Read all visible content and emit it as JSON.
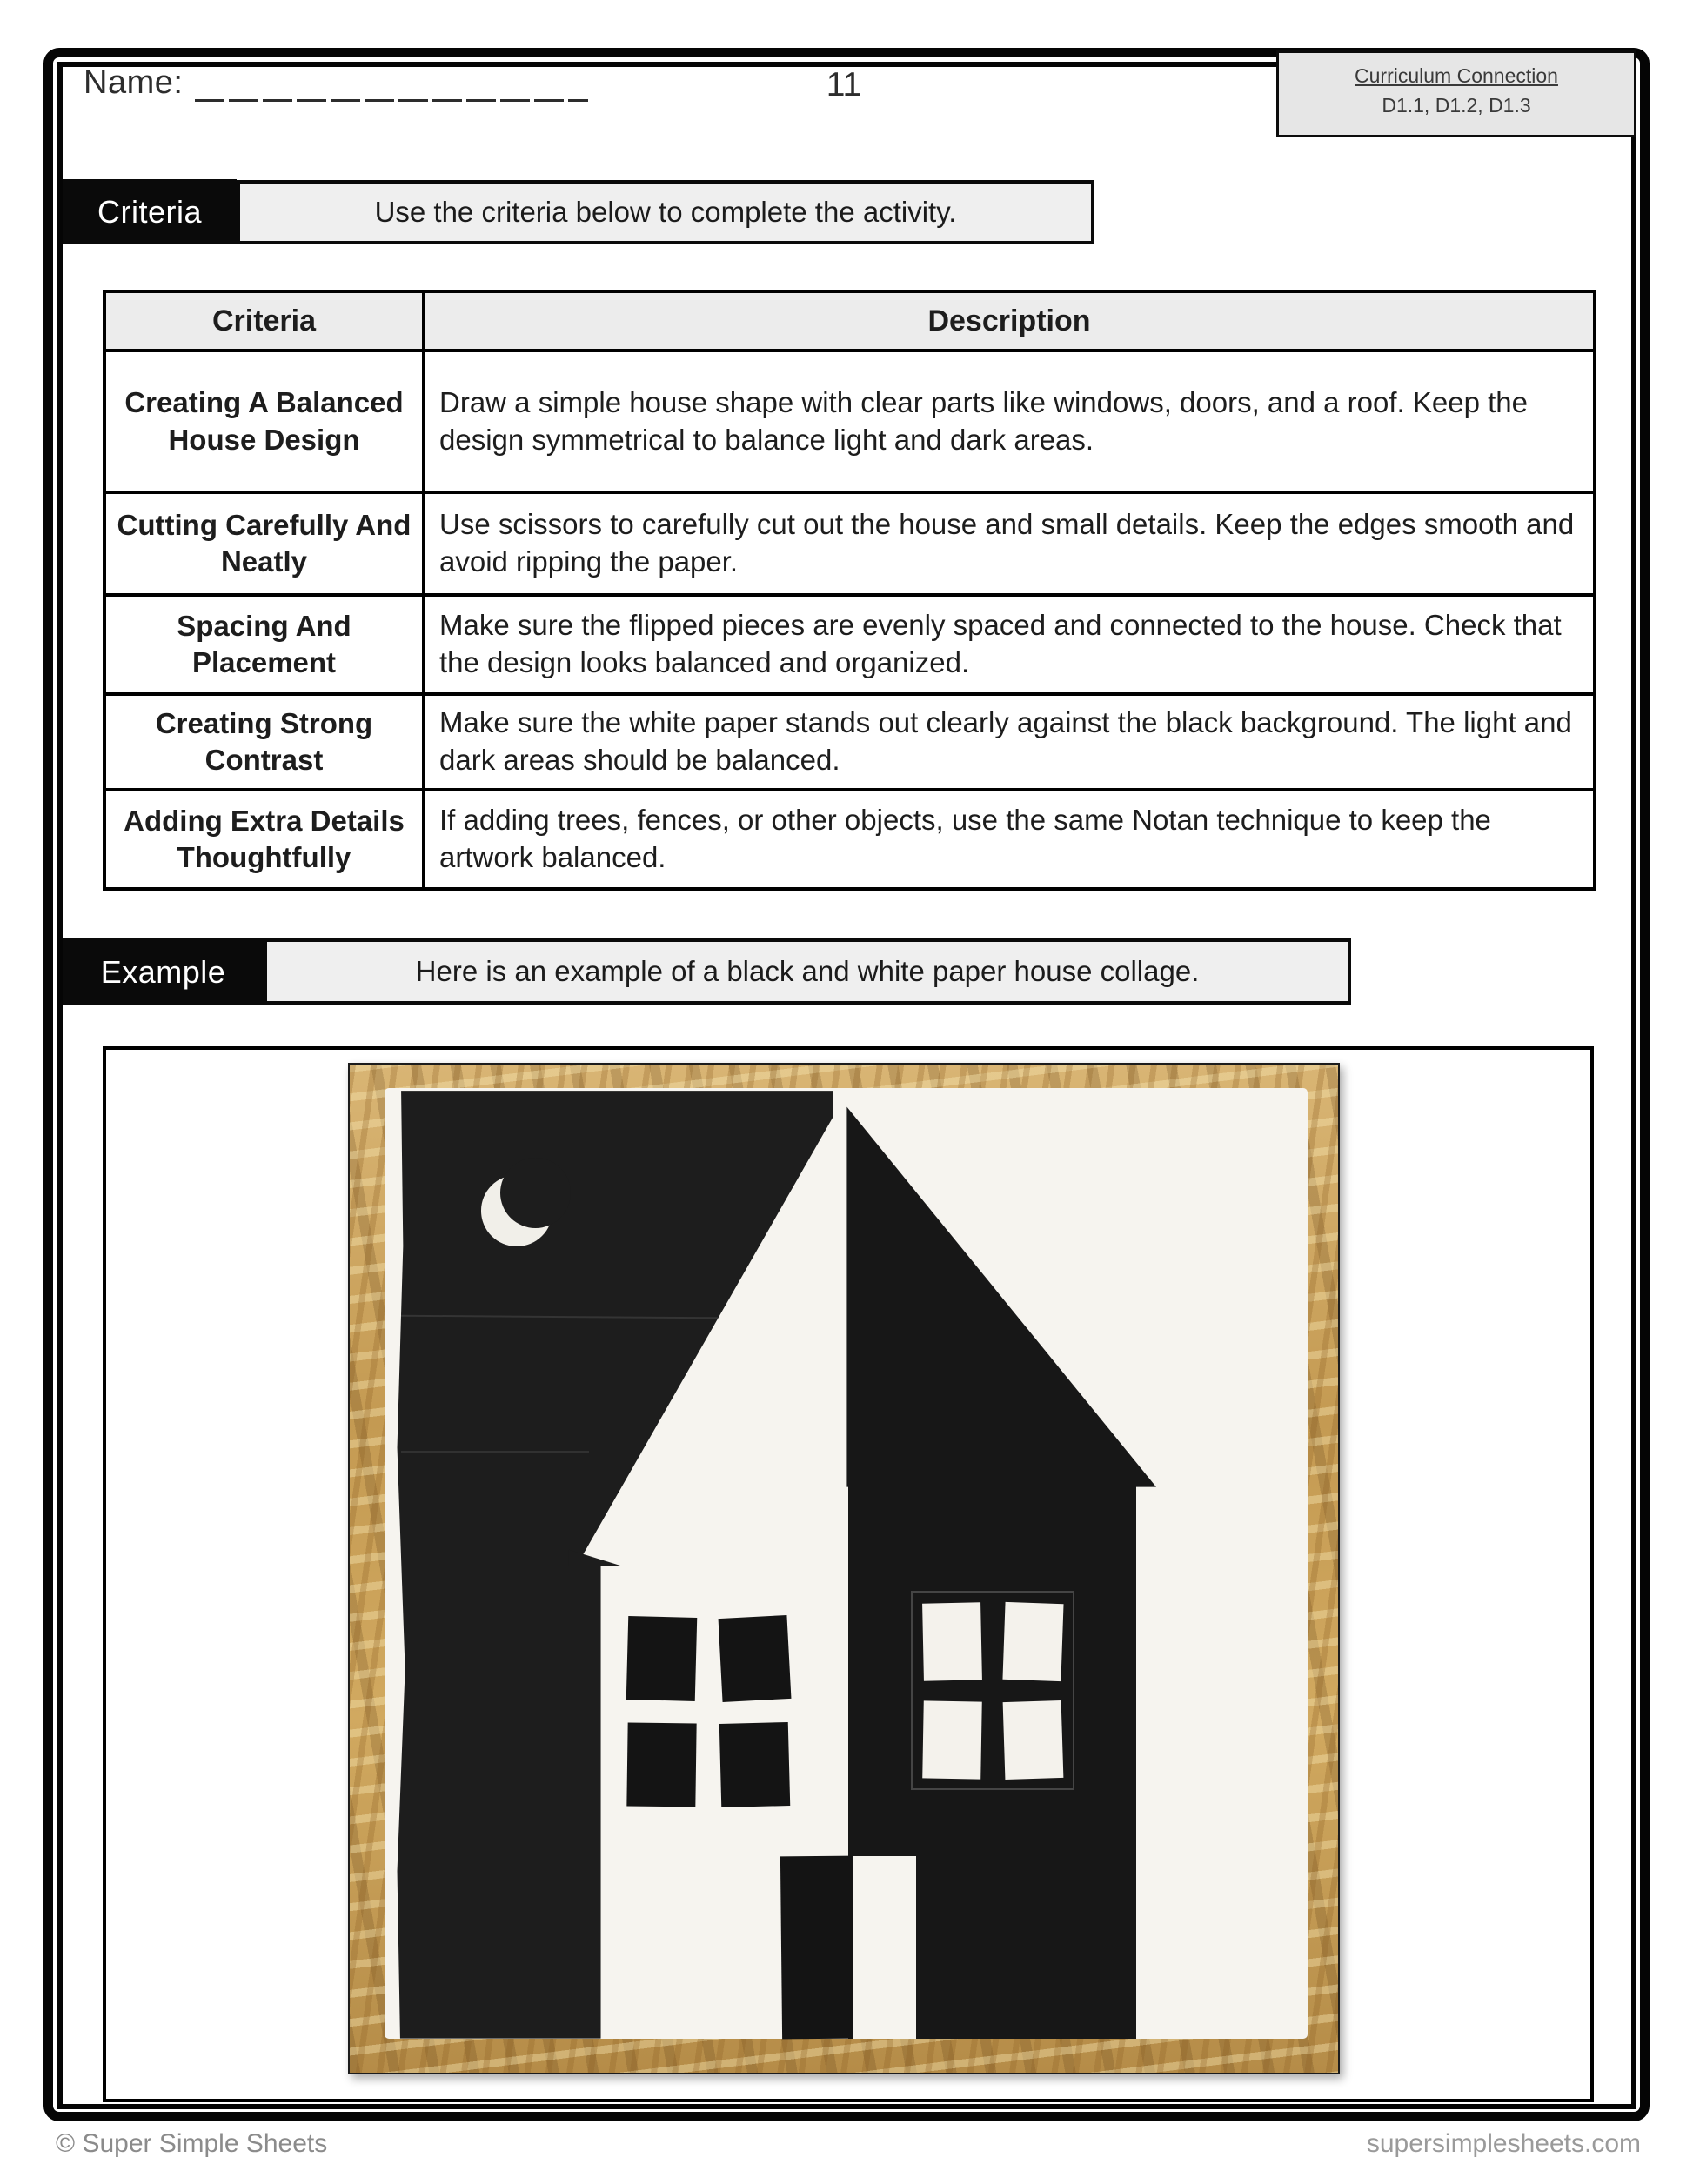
{
  "page": {
    "header": {
      "name_label": "Name:",
      "page_number": "11",
      "curriculum_box": {
        "title": "Curriculum Connection",
        "codes": "D1.1, D1.2, D1.3"
      }
    },
    "criteria_section": {
      "label": "Criteria",
      "instruction": "Use the criteria below to complete the activity."
    },
    "table": {
      "headers": [
        "Criteria",
        "Description"
      ],
      "rows": [
        {
          "criteria": "Creating A Balanced House Design",
          "description": "Draw a simple house shape with clear parts like windows, doors, and a roof. Keep the design symmetrical to balance light and dark areas."
        },
        {
          "criteria": "Cutting Carefully And Neatly",
          "description": "Use scissors to carefully cut out the house and small details. Keep the edges smooth and avoid ripping the paper."
        },
        {
          "criteria": "Spacing And Placement",
          "description": "Make sure the flipped pieces are evenly spaced and connected to the house. Check that the design looks balanced and organized."
        },
        {
          "criteria": "Creating Strong Contrast",
          "description": "Make sure the white paper stands out clearly against the black background. The light and dark areas should be balanced."
        },
        {
          "criteria": "Adding Extra Details Thoughtfully",
          "description": "If adding trees, fences, or other objects, use the same Notan technique to keep the artwork balanced."
        }
      ]
    },
    "example_section": {
      "label": "Example",
      "instruction": "Here is an example of a black and white paper house collage."
    },
    "example_image": {
      "alt": "Notan-style black and white paper house collage with crescent moon, windows and doors, on a wood board background",
      "colors": {
        "wood": "#c9a25b",
        "black_paper": "#1d1d1d",
        "white_paper": "#f6f4ef"
      }
    },
    "footer": {
      "copyright": "© Super Simple Sheets",
      "website": "supersimplesheets.com"
    }
  }
}
